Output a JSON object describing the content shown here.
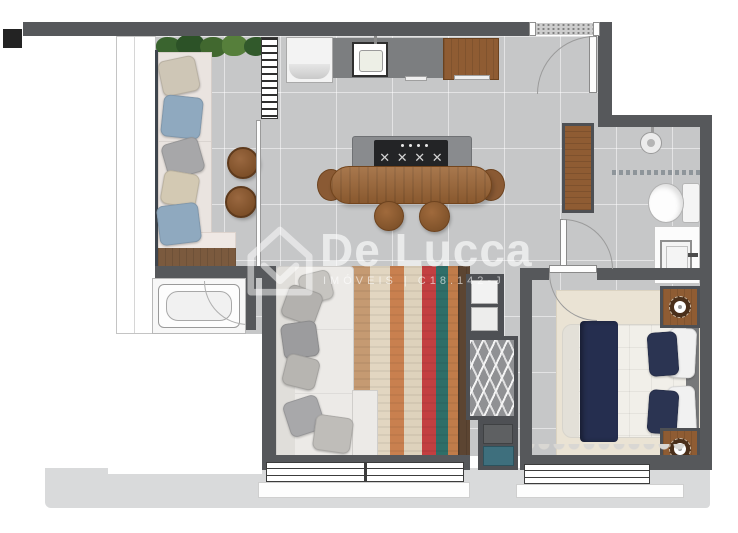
{
  "watermark": {
    "brand": "De Lucca",
    "tagline": "IMÓVEIS   |   C18.142-J",
    "logo_icon": "house-outline-icon"
  },
  "colors": {
    "wall": "#56585b",
    "floor": "#c6c7c8",
    "slab": "#d9dadb",
    "wood": "#8f5c33",
    "wood_dark": "#5c4532",
    "rug_tan": "#c59a72",
    "rug_red": "#c33f41",
    "rug_teal": "#2f6e68",
    "navy": "#252e4f",
    "pillow_blue": "#8fa9bf",
    "plant_green": "#41682f",
    "laundry_teal": "#3e6f7d",
    "watermark_text": "rgba(255,255,255,0.62)"
  },
  "furniture": [
    "balcony-bench",
    "balcony-side-tables",
    "bathtub",
    "kitchen-fridge",
    "kitchen-sink",
    "kitchen-cabinet",
    "island-cooktop",
    "dining-table",
    "stools",
    "entry-door",
    "hall-wardrobe",
    "shower",
    "toilet",
    "vanity-sink",
    "sofa",
    "striped-rug",
    "tv-panel",
    "laundry-cabinet",
    "drying-rack",
    "laundry-bins",
    "double-bed",
    "nightstand-lamps",
    "bedroom-rug",
    "windows"
  ]
}
